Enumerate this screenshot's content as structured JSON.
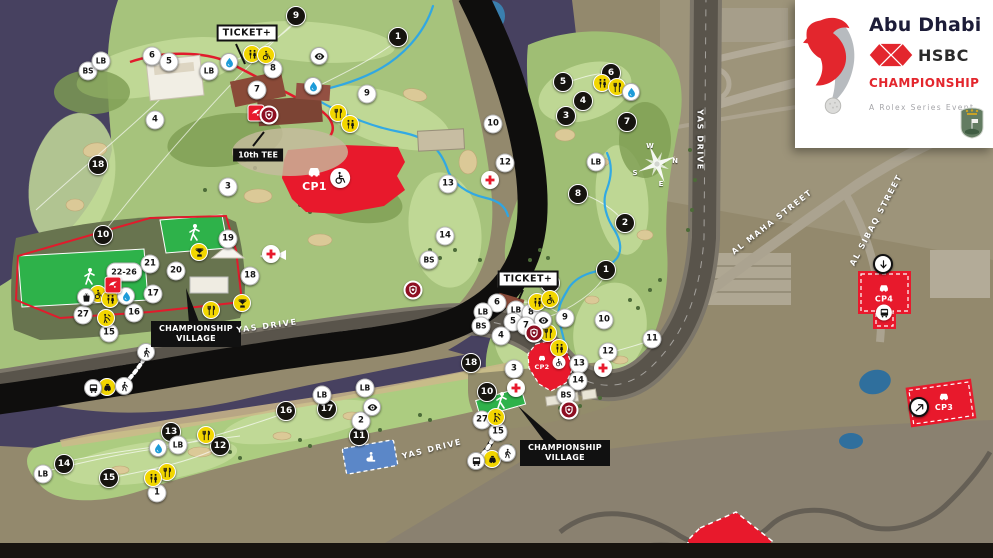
{
  "logo": {
    "city": "Abu Dhabi",
    "bank": "HSBC",
    "event": "CHAMPIONSHIP",
    "tagline": "A Rolex Series Event"
  },
  "colors": {
    "red": "#e8192c",
    "yellow": "#f2d600",
    "route_blue": "#2aa7e8",
    "stand_green": "#2eb24a",
    "water": "#474160"
  },
  "map": {
    "hole_markers": [
      {
        "n": "1",
        "x": 398,
        "y": 37
      },
      {
        "n": "9",
        "x": 296,
        "y": 16
      },
      {
        "n": "18",
        "x": 98,
        "y": 165
      },
      {
        "n": "10",
        "x": 103,
        "y": 235
      },
      {
        "n": "11",
        "x": 359,
        "y": 436
      },
      {
        "n": "12",
        "x": 220,
        "y": 446
      },
      {
        "n": "13",
        "x": 171,
        "y": 432
      },
      {
        "n": "14",
        "x": 64,
        "y": 464
      },
      {
        "n": "15",
        "x": 109,
        "y": 478
      },
      {
        "n": "16",
        "x": 286,
        "y": 411
      },
      {
        "n": "17",
        "x": 327,
        "y": 409
      },
      {
        "n": "2",
        "x": 625,
        "y": 223
      },
      {
        "n": "3",
        "x": 566,
        "y": 116
      },
      {
        "n": "4",
        "x": 583,
        "y": 101
      },
      {
        "n": "5",
        "x": 563,
        "y": 82
      },
      {
        "n": "6",
        "x": 611,
        "y": 73
      },
      {
        "n": "7",
        "x": 627,
        "y": 122
      },
      {
        "n": "8",
        "x": 578,
        "y": 194
      },
      {
        "n": "9",
        "x": 550,
        "y": 283
      },
      {
        "n": "1",
        "x": 606,
        "y": 270
      },
      {
        "n": "18",
        "x": 471,
        "y": 363
      },
      {
        "n": "10",
        "x": 487,
        "y": 392
      }
    ],
    "venue_markers": [
      {
        "n": "BS",
        "x": 88,
        "y": 71
      },
      {
        "n": "LB",
        "x": 101,
        "y": 61
      },
      {
        "n": "6",
        "x": 152,
        "y": 56
      },
      {
        "n": "5",
        "x": 169,
        "y": 62
      },
      {
        "n": "LB",
        "x": 209,
        "y": 71
      },
      {
        "n": "8",
        "x": 273,
        "y": 69
      },
      {
        "n": "7",
        "x": 257,
        "y": 90
      },
      {
        "n": "4",
        "x": 155,
        "y": 120
      },
      {
        "n": "3",
        "x": 228,
        "y": 187
      },
      {
        "n": "9",
        "x": 367,
        "y": 94
      },
      {
        "n": "10",
        "x": 493,
        "y": 124
      },
      {
        "n": "12",
        "x": 505,
        "y": 163
      },
      {
        "n": "13",
        "x": 448,
        "y": 184
      },
      {
        "n": "14",
        "x": 445,
        "y": 236
      },
      {
        "n": "BS",
        "x": 429,
        "y": 260
      },
      {
        "n": "18",
        "x": 250,
        "y": 276
      },
      {
        "n": "19",
        "x": 228,
        "y": 239
      },
      {
        "n": "21",
        "x": 150,
        "y": 264
      },
      {
        "n": "22-26",
        "x": 124,
        "y": 272
      },
      {
        "n": "20",
        "x": 176,
        "y": 271
      },
      {
        "n": "17",
        "x": 153,
        "y": 294
      },
      {
        "n": "16",
        "x": 134,
        "y": 313
      },
      {
        "n": "27",
        "x": 83,
        "y": 315
      },
      {
        "n": "15",
        "x": 109,
        "y": 333
      },
      {
        "n": "LB",
        "x": 178,
        "y": 445
      },
      {
        "n": "LB",
        "x": 43,
        "y": 474
      },
      {
        "n": "1",
        "x": 157,
        "y": 493
      },
      {
        "n": "LB",
        "x": 322,
        "y": 395
      },
      {
        "n": "LB",
        "x": 365,
        "y": 388
      },
      {
        "n": "2",
        "x": 361,
        "y": 421
      },
      {
        "n": "6",
        "x": 497,
        "y": 303
      },
      {
        "n": "LB",
        "x": 483,
        "y": 312
      },
      {
        "n": "LB",
        "x": 516,
        "y": 310
      },
      {
        "n": "BS",
        "x": 481,
        "y": 326
      },
      {
        "n": "8",
        "x": 531,
        "y": 313
      },
      {
        "n": "5",
        "x": 513,
        "y": 322
      },
      {
        "n": "7",
        "x": 526,
        "y": 326
      },
      {
        "n": "4",
        "x": 501,
        "y": 336
      },
      {
        "n": "9",
        "x": 565,
        "y": 318
      },
      {
        "n": "10",
        "x": 604,
        "y": 320
      },
      {
        "n": "11",
        "x": 652,
        "y": 339
      },
      {
        "n": "12",
        "x": 608,
        "y": 352
      },
      {
        "n": "13",
        "x": 579,
        "y": 364
      },
      {
        "n": "14",
        "x": 578,
        "y": 381
      },
      {
        "n": "BS",
        "x": 566,
        "y": 395
      },
      {
        "n": "3",
        "x": 514,
        "y": 369
      },
      {
        "n": "15",
        "x": 498,
        "y": 432
      },
      {
        "n": "27",
        "x": 482,
        "y": 420
      },
      {
        "n": "LB",
        "x": 596,
        "y": 162
      }
    ],
    "facilities": [
      {
        "kind": "yellow",
        "icon": "restroom",
        "x": 252,
        "y": 54
      },
      {
        "kind": "yellow",
        "icon": "wheelchair",
        "x": 266,
        "y": 55
      },
      {
        "kind": "yellow",
        "icon": "food",
        "x": 338,
        "y": 113
      },
      {
        "kind": "yellow",
        "icon": "restroom",
        "x": 350,
        "y": 124
      },
      {
        "kind": "yellow",
        "icon": "restroom",
        "x": 602,
        "y": 83
      },
      {
        "kind": "yellow",
        "icon": "food",
        "x": 617,
        "y": 87
      },
      {
        "kind": "yellow",
        "icon": "restroom",
        "x": 537,
        "y": 302
      },
      {
        "kind": "yellow",
        "icon": "wheelchair",
        "x": 550,
        "y": 299
      },
      {
        "kind": "yellow",
        "icon": "food",
        "x": 548,
        "y": 333
      },
      {
        "kind": "yellow",
        "icon": "restroom",
        "x": 559,
        "y": 348
      },
      {
        "kind": "yellow",
        "icon": "trophy",
        "x": 199,
        "y": 252
      },
      {
        "kind": "yellow",
        "icon": "trophy",
        "x": 242,
        "y": 303
      },
      {
        "kind": "yellow",
        "icon": "wheelchair",
        "x": 98,
        "y": 294
      },
      {
        "kind": "yellow",
        "icon": "restroom",
        "x": 110,
        "y": 299
      },
      {
        "kind": "yellow",
        "icon": "autograph",
        "x": 106,
        "y": 318
      },
      {
        "kind": "yellow",
        "icon": "food",
        "x": 211,
        "y": 310
      },
      {
        "kind": "yellow",
        "icon": "taxi",
        "x": 107,
        "y": 387
      },
      {
        "kind": "yellow",
        "icon": "taxi",
        "x": 492,
        "y": 459
      },
      {
        "kind": "yellow",
        "icon": "autograph",
        "x": 496,
        "y": 417
      },
      {
        "kind": "yellow",
        "icon": "food",
        "x": 206,
        "y": 435
      },
      {
        "kind": "yellow",
        "icon": "food",
        "x": 167,
        "y": 472
      },
      {
        "kind": "yellow",
        "icon": "restroom",
        "x": 153,
        "y": 478
      },
      {
        "kind": "white",
        "icon": "water",
        "x": 229,
        "y": 62
      },
      {
        "kind": "white",
        "icon": "water",
        "x": 313,
        "y": 86
      },
      {
        "kind": "white",
        "icon": "water",
        "x": 126,
        "y": 296
      },
      {
        "kind": "white",
        "icon": "water",
        "x": 158,
        "y": 448
      },
      {
        "kind": "white",
        "icon": "water",
        "x": 631,
        "y": 92
      },
      {
        "kind": "white",
        "icon": "eye",
        "x": 319,
        "y": 56
      },
      {
        "kind": "white",
        "icon": "eye",
        "x": 372,
        "y": 407
      },
      {
        "kind": "white",
        "icon": "eye",
        "x": 543,
        "y": 320
      },
      {
        "kind": "white",
        "icon": "bus",
        "x": 93,
        "y": 388
      },
      {
        "kind": "white",
        "icon": "bus",
        "x": 476,
        "y": 461
      },
      {
        "kind": "white",
        "icon": "walk",
        "x": 146,
        "y": 352
      },
      {
        "kind": "white",
        "icon": "walk",
        "x": 124,
        "y": 386
      },
      {
        "kind": "white",
        "icon": "walk",
        "x": 507,
        "y": 453
      },
      {
        "kind": "white",
        "icon": "bag",
        "x": 86,
        "y": 297
      },
      {
        "kind": "medical",
        "icon": "cross",
        "x": 271,
        "y": 254
      },
      {
        "kind": "medical",
        "icon": "cross",
        "x": 490,
        "y": 180
      },
      {
        "kind": "medical",
        "icon": "cross",
        "x": 603,
        "y": 368
      },
      {
        "kind": "medical",
        "icon": "cross",
        "x": 516,
        "y": 388
      },
      {
        "kind": "redsq",
        "icon": "falcon",
        "x": 256,
        "y": 113
      },
      {
        "kind": "redsq",
        "icon": "falcon",
        "x": 113,
        "y": 285
      },
      {
        "kind": "redbadge",
        "icon": "shield",
        "x": 269,
        "y": 115
      },
      {
        "kind": "redbadge",
        "icon": "shield",
        "x": 413,
        "y": 290
      },
      {
        "kind": "redbadge",
        "icon": "shield",
        "x": 534,
        "y": 333
      },
      {
        "kind": "redbadge",
        "icon": "shield",
        "x": 569,
        "y": 410
      },
      {
        "kind": "shuttle",
        "icon": "arrow-down",
        "x": 883,
        "y": 264
      },
      {
        "kind": "shuttle",
        "icon": "arrow-ne",
        "x": 919,
        "y": 407
      },
      {
        "kind": "prayer",
        "icon": "prayer",
        "x": 370,
        "y": 457
      }
    ],
    "labels": [
      {
        "kind": "ticket",
        "text": "TICKET+",
        "x": 247,
        "y": 33
      },
      {
        "kind": "ticket",
        "text": "TICKET+",
        "x": 528,
        "y": 279
      },
      {
        "kind": "tag",
        "text": "10th TEE",
        "x": 258,
        "y": 155
      },
      {
        "kind": "village",
        "text": "CHAMPIONSHIP VILLAGE",
        "x": 196,
        "y": 334
      },
      {
        "kind": "village",
        "text": "CHAMPIONSHIP VILLAGE",
        "x": 565,
        "y": 453
      },
      {
        "kind": "road",
        "text": "YAS DRIVE",
        "x": 267,
        "y": 326,
        "rot": -8
      },
      {
        "kind": "road",
        "text": "YAS DRIVE",
        "x": 432,
        "y": 449,
        "rot": -14
      },
      {
        "kind": "road",
        "text": "YAS DRIVE",
        "x": 700,
        "y": 140,
        "rot": 90
      },
      {
        "kind": "road",
        "text": "AL MAHA STREET",
        "x": 772,
        "y": 222,
        "rot": -38
      },
      {
        "kind": "road",
        "text": "AL SIBAQ STREET",
        "x": 876,
        "y": 220,
        "rot": -62
      }
    ],
    "parking": [
      {
        "id": "CP1",
        "x": 326,
        "y": 178,
        "features": [
          "car",
          "wheelchair"
        ]
      },
      {
        "id": "CP2",
        "x": 550,
        "y": 362,
        "features": [
          "car",
          "wheelchair"
        ]
      },
      {
        "id": "CP3",
        "x": 944,
        "y": 401,
        "features": [
          "car"
        ]
      },
      {
        "id": "CP4",
        "x": 884,
        "y": 301,
        "features": [
          "car",
          "bus"
        ]
      }
    ],
    "compass": {
      "x": 657,
      "y": 164,
      "points": [
        {
          "t": "W",
          "x": 650,
          "y": 146
        },
        {
          "t": "N",
          "x": 675,
          "y": 161
        },
        {
          "t": "E",
          "x": 661,
          "y": 184
        },
        {
          "t": "S",
          "x": 635,
          "y": 173
        }
      ]
    }
  }
}
